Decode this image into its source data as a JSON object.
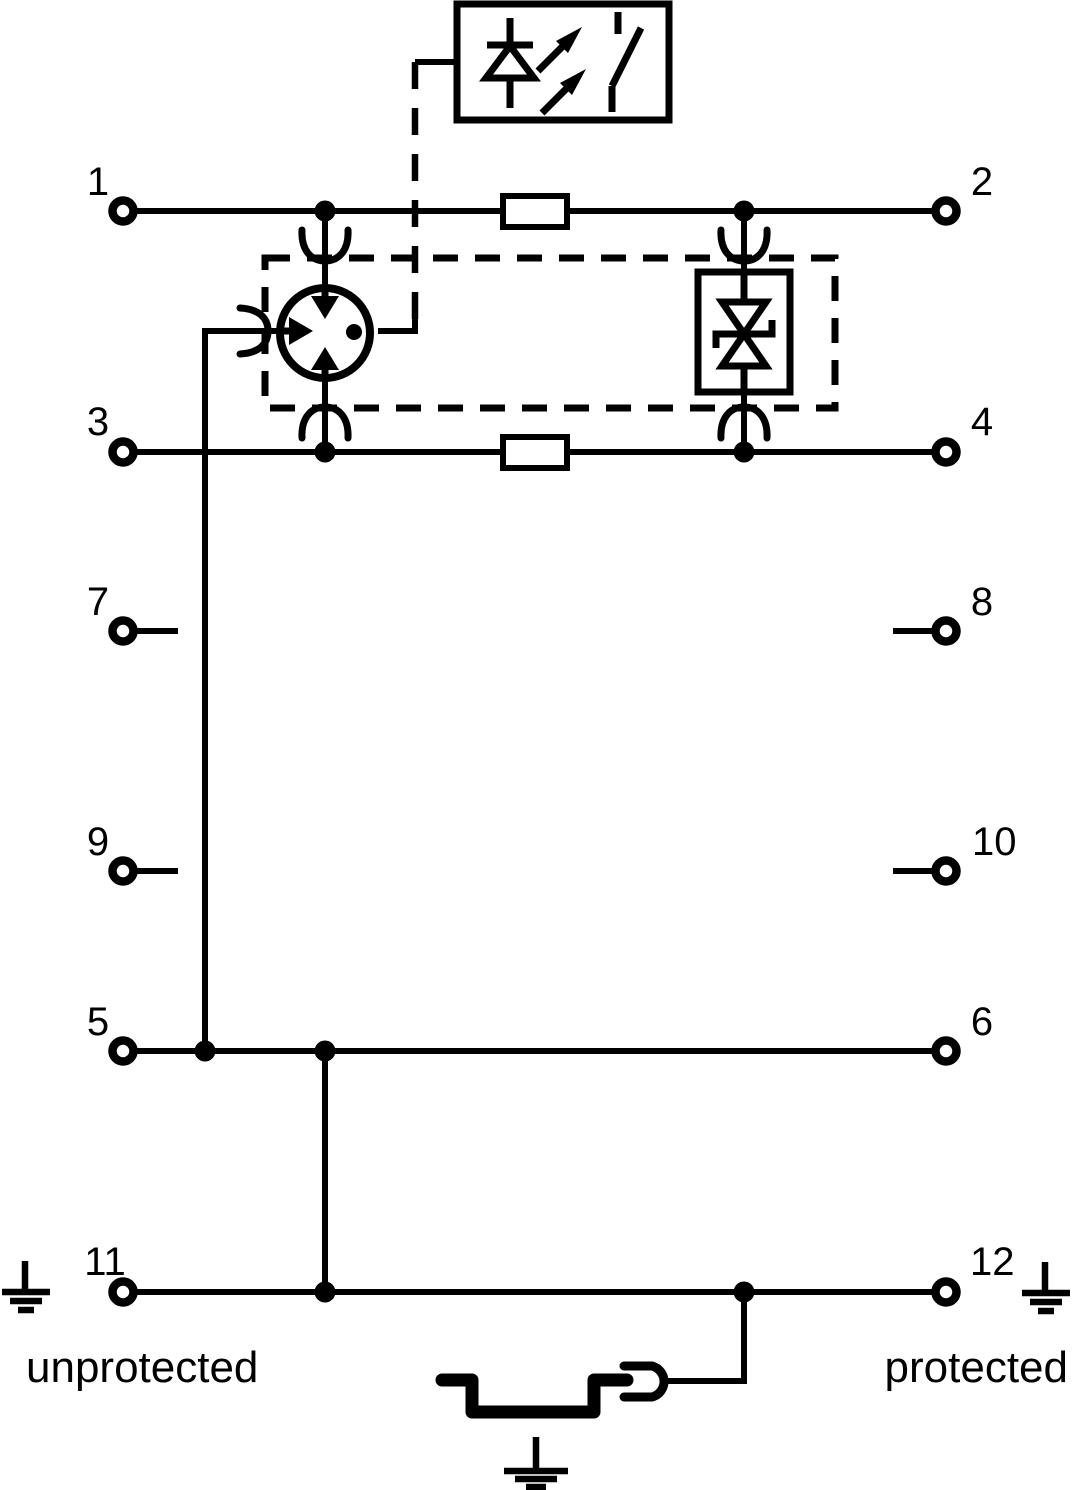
{
  "diagram": {
    "terminals": [
      {
        "label": "1"
      },
      {
        "label": "2"
      },
      {
        "label": "3"
      },
      {
        "label": "4"
      },
      {
        "label": "7"
      },
      {
        "label": "8"
      },
      {
        "label": "9"
      },
      {
        "label": "10"
      },
      {
        "label": "5"
      },
      {
        "label": "6"
      },
      {
        "label": "11"
      },
      {
        "label": "12"
      }
    ],
    "zone_labels": {
      "left": "unprotected",
      "right": "protected"
    },
    "colors": {
      "line": "#000000",
      "background": "#ffffff"
    }
  }
}
